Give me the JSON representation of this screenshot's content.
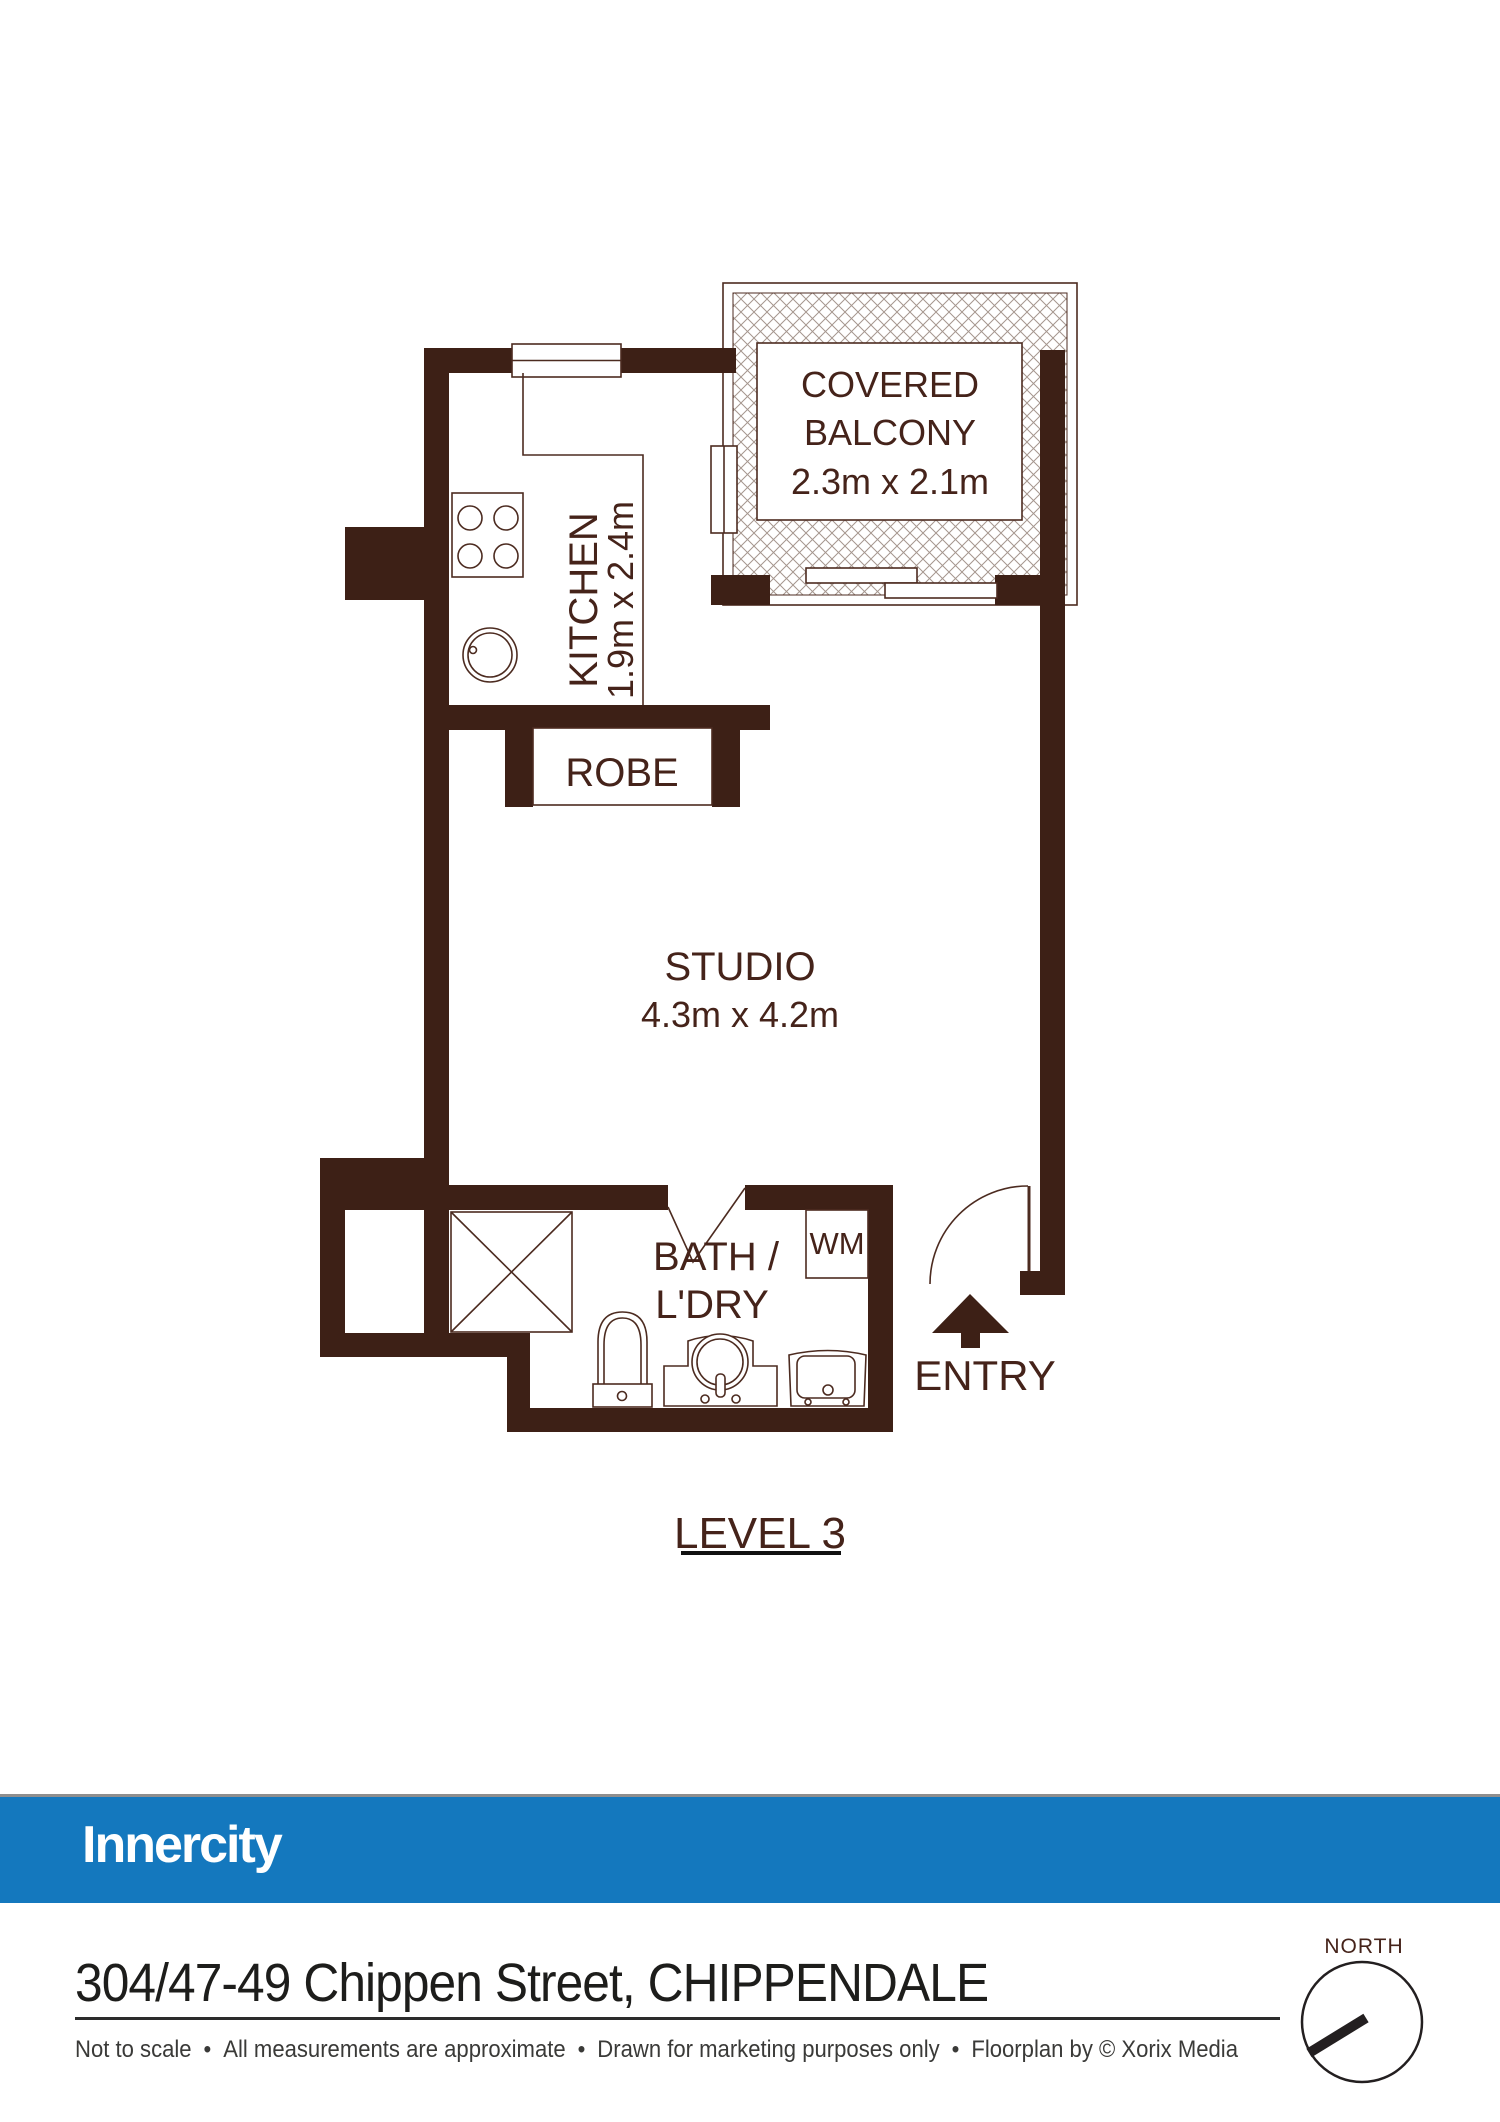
{
  "plan": {
    "balcony": {
      "line1": "COVERED",
      "line2": "BALCONY",
      "dims": "2.3m x 2.1m"
    },
    "kitchen": {
      "label": "KITCHEN",
      "dims": "1.9m x 2.4m"
    },
    "robe": {
      "label": "ROBE"
    },
    "studio": {
      "label": "STUDIO",
      "dims": "4.3m x 4.2m"
    },
    "bath": {
      "line1": "BATH /",
      "line2": "L'DRY"
    },
    "wm": {
      "label": "WM"
    },
    "entry": {
      "label": "ENTRY"
    },
    "level_label": "LEVEL 3"
  },
  "compass": {
    "label": "NORTH"
  },
  "branding": {
    "logo_text": "Innercity",
    "brand_blue": "#1478BE"
  },
  "footer": {
    "address": "304/47-49 Chippen Street, CHIPPENDALE",
    "separator": "•",
    "disclaimer": [
      "Not to scale",
      "All measurements are approximate",
      "Drawn for marketing purposes only",
      "Floorplan by © Xorix Media"
    ]
  },
  "colors": {
    "wall": "#3D2016",
    "accent_blue": "#1478BE",
    "hatch": "#a5968e"
  }
}
